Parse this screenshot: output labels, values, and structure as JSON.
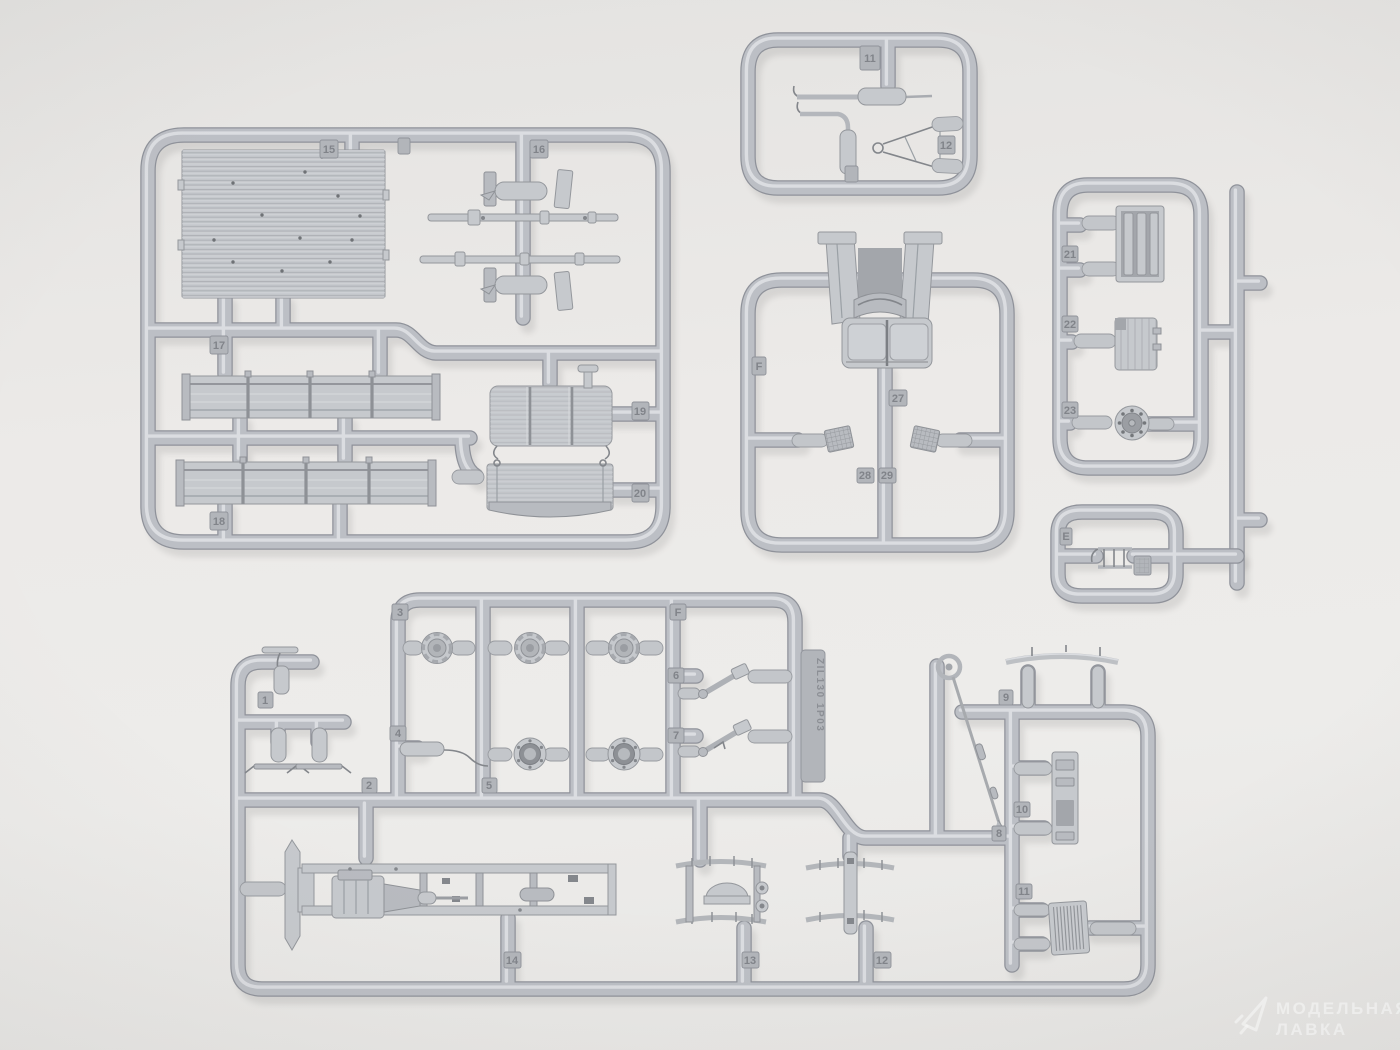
{
  "colors": {
    "background": "#eceae8",
    "plastic": "#bcbfc5",
    "plastic_highlight": "#e0e2e5",
    "plastic_edge": "#8f929a",
    "watermark": "rgba(255,255,255,0.58)"
  },
  "mold_text": {
    "zil": "ZIL130 1P03"
  },
  "tags": {
    "a": {
      "t15": "15",
      "t16": "16",
      "t17": "17",
      "t18": "18",
      "t19": "19",
      "t20": "20"
    },
    "b": {
      "t11": "11",
      "t12": "12"
    },
    "c": {
      "tF": "F",
      "t27": "27",
      "t28": "28",
      "t29": "29"
    },
    "d": {
      "t21": "21",
      "t22": "22",
      "t23": "23"
    },
    "e": {
      "tE": "E"
    },
    "f": {
      "t1": "1",
      "t2": "2",
      "t3": "3",
      "t4": "4",
      "t5": "5",
      "t6": "6",
      "t7": "7",
      "t8": "8",
      "t9": "9",
      "t10": "10",
      "t11": "11",
      "t12": "12",
      "t13": "13",
      "t14": "14",
      "tF": "F"
    }
  },
  "watermark": {
    "line1": "МОДЕЛЬНАЯ",
    "line2": "ЛАВКА",
    "logo": "paper-plane-logo"
  }
}
